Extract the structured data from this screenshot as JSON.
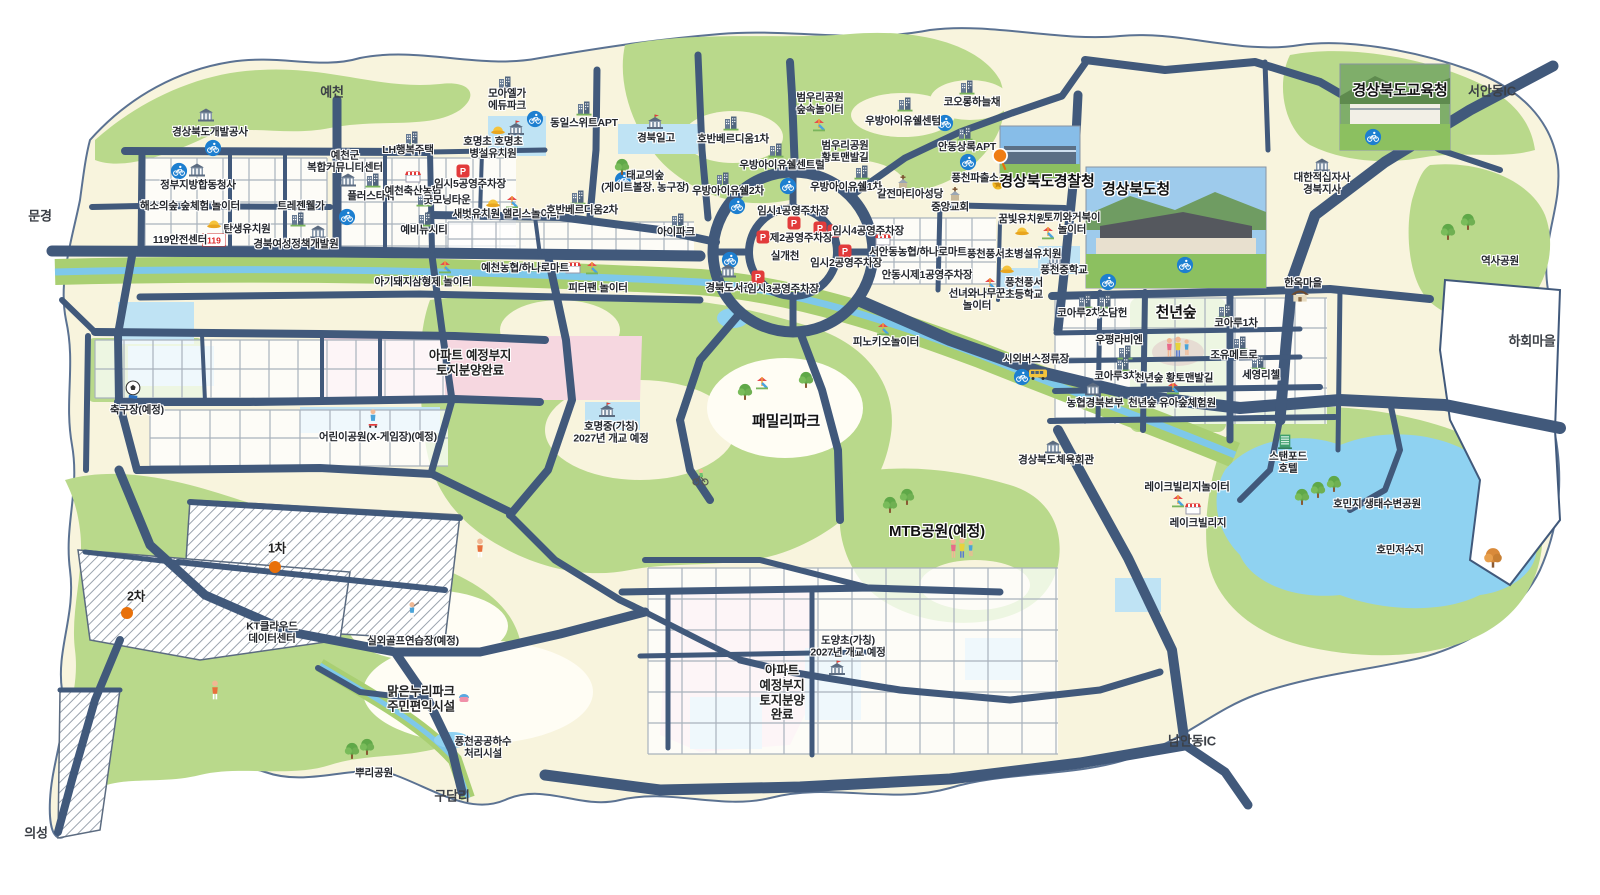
{
  "map": {
    "region_name_hint": "",
    "colors": {
      "road": "#41597b",
      "land": "#f8f4dd",
      "park": "#b9d98b",
      "water": "#8fd2f1",
      "stream_band": "#a9cf72",
      "zone_pink": "#f6d7e0",
      "zone_blue": "#bfe3f4",
      "marker_bike_blue": "#1d7fd0",
      "marker_parking_red": "#e23b3b",
      "dot_orange": "#e8700a"
    },
    "labels": [
      {
        "t": "예천",
        "x": 332,
        "y": 92,
        "s": "e"
      },
      {
        "t": "문경",
        "x": 40,
        "y": 216,
        "s": "e"
      },
      {
        "t": "의성",
        "x": 36,
        "y": 833,
        "s": "e"
      },
      {
        "t": "구담리",
        "x": 452,
        "y": 796,
        "s": "e"
      },
      {
        "t": "남안동IC",
        "x": 1192,
        "y": 741,
        "s": "e"
      },
      {
        "t": "서안동IC",
        "x": 1492,
        "y": 91,
        "s": "e"
      },
      {
        "t": "하회마을",
        "x": 1532,
        "y": 341,
        "s": "e"
      },
      {
        "t": "역사공원",
        "x": 1500,
        "y": 261,
        "s": "n"
      },
      {
        "t": "경상북도개발공사",
        "x": 210,
        "y": 132,
        "s": "n"
      },
      {
        "t": "정부지방합동청사",
        "x": 198,
        "y": 185,
        "s": "n"
      },
      {
        "t": "해소의숲 숲체험 놀이터",
        "x": 190,
        "y": 206,
        "s": "n"
      },
      {
        "t": "119안전센터",
        "x": 180,
        "y": 240,
        "s": "n"
      },
      {
        "t": "탄생유치원",
        "x": 247,
        "y": 229,
        "s": "n"
      },
      {
        "t": "트레젠웰가",
        "x": 301,
        "y": 206,
        "s": "n"
      },
      {
        "t": "경북여성정책개발원",
        "x": 296,
        "y": 244,
        "s": "n"
      },
      {
        "t": "예천군\n복합커뮤니티센터",
        "x": 345,
        "y": 162,
        "s": "n"
      },
      {
        "t": "LH행복주택",
        "x": 408,
        "y": 150,
        "s": "n"
      },
      {
        "t": "플러스타워",
        "x": 371,
        "y": 196,
        "s": "n"
      },
      {
        "t": "예천축산농협",
        "x": 413,
        "y": 191,
        "s": "n"
      },
      {
        "t": "굿모닝타운",
        "x": 447,
        "y": 200,
        "s": "n"
      },
      {
        "t": "예비뉴시티",
        "x": 424,
        "y": 230,
        "s": "n"
      },
      {
        "t": "임시5공영주차장",
        "x": 470,
        "y": 184,
        "s": "n"
      },
      {
        "t": "모아엘가\n에듀파크",
        "x": 507,
        "y": 100,
        "s": "n"
      },
      {
        "t": "호명초 호명초\n병설유치원",
        "x": 493,
        "y": 148,
        "s": "n"
      },
      {
        "t": "동일스위트APT",
        "x": 584,
        "y": 123,
        "s": "n"
      },
      {
        "t": "경북일고",
        "x": 656,
        "y": 138,
        "s": "n"
      },
      {
        "t": "태교의숲\n(게이트볼장, 농구장)",
        "x": 645,
        "y": 182,
        "s": "n"
      },
      {
        "t": "새벗유치원 앨리스놀이터",
        "x": 506,
        "y": 214,
        "s": "n"
      },
      {
        "t": "호반베르디움2차",
        "x": 582,
        "y": 210,
        "s": "n"
      },
      {
        "t": "아이파크",
        "x": 676,
        "y": 232,
        "s": "n"
      },
      {
        "t": "호반베르디움1차",
        "x": 733,
        "y": 139,
        "s": "n"
      },
      {
        "t": "범우리공원\n숲속놀이터",
        "x": 820,
        "y": 104,
        "s": "n"
      },
      {
        "t": "범우리공원\n황토맨발길",
        "x": 845,
        "y": 152,
        "s": "n"
      },
      {
        "t": "우방아이유쉘센텀",
        "x": 903,
        "y": 121,
        "s": "n"
      },
      {
        "t": "코오롱하늘채",
        "x": 972,
        "y": 102,
        "s": "n"
      },
      {
        "t": "우방아이유쉘센트럴",
        "x": 782,
        "y": 165,
        "s": "n"
      },
      {
        "t": "우방아이유쉘2차",
        "x": 728,
        "y": 191,
        "s": "n"
      },
      {
        "t": "우방아이유쉘1차",
        "x": 846,
        "y": 187,
        "s": "n"
      },
      {
        "t": "갈전마티아성당",
        "x": 910,
        "y": 194,
        "s": "n"
      },
      {
        "t": "안동상록APT",
        "x": 967,
        "y": 147,
        "s": "n"
      },
      {
        "t": "풍천파출소",
        "x": 975,
        "y": 178,
        "s": "n"
      },
      {
        "t": "경상북도경찰청",
        "x": 1047,
        "y": 182,
        "s": "b"
      },
      {
        "t": "경상북도청",
        "x": 1136,
        "y": 190,
        "s": "b"
      },
      {
        "t": "중앙교회",
        "x": 950,
        "y": 207,
        "s": "n"
      },
      {
        "t": "꿈빛유치원",
        "x": 1022,
        "y": 219,
        "s": "n"
      },
      {
        "t": "토끼와거북이\n놀이터",
        "x": 1072,
        "y": 224,
        "s": "n"
      },
      {
        "t": "풍천풍서초병설유치원",
        "x": 1014,
        "y": 254,
        "s": "n"
      },
      {
        "t": "풍천중학교",
        "x": 1064,
        "y": 270,
        "s": "n"
      },
      {
        "t": "풍천풍서\n초등학교",
        "x": 1024,
        "y": 289,
        "s": "n"
      },
      {
        "t": "선녀와나무꾼\n놀이터",
        "x": 977,
        "y": 300,
        "s": "n"
      },
      {
        "t": "임시1공영주차장",
        "x": 793,
        "y": 211,
        "s": "n"
      },
      {
        "t": "제2공영주차장",
        "x": 801,
        "y": 238,
        "s": "n"
      },
      {
        "t": "임시4공영주차장",
        "x": 868,
        "y": 231,
        "s": "n"
      },
      {
        "t": "실개천",
        "x": 785,
        "y": 256,
        "s": "n"
      },
      {
        "t": "임시2공영주차장",
        "x": 846,
        "y": 263,
        "s": "n"
      },
      {
        "t": "서안동농협/하나로마트",
        "x": 918,
        "y": 252,
        "s": "n"
      },
      {
        "t": "안동시제1공영주차장",
        "x": 927,
        "y": 275,
        "s": "n"
      },
      {
        "t": "경북도서관",
        "x": 729,
        "y": 288,
        "s": "n"
      },
      {
        "t": "임시3공영주차장",
        "x": 783,
        "y": 289,
        "s": "n"
      },
      {
        "t": "예천농협/하나로마트",
        "x": 525,
        "y": 268,
        "s": "n"
      },
      {
        "t": "아기돼지삼형제 놀이터",
        "x": 423,
        "y": 282,
        "s": "n"
      },
      {
        "t": "피터팬 놀이터",
        "x": 598,
        "y": 288,
        "s": "n"
      },
      {
        "t": "피노키오놀이터",
        "x": 886,
        "y": 342,
        "s": "n"
      },
      {
        "t": "시외버스정류장",
        "x": 1036,
        "y": 359,
        "s": "n"
      },
      {
        "t": "코아루2차",
        "x": 1079,
        "y": 313,
        "s": "n"
      },
      {
        "t": "소담헌",
        "x": 1113,
        "y": 313,
        "s": "n"
      },
      {
        "t": "우평라비엔",
        "x": 1119,
        "y": 340,
        "s": "n"
      },
      {
        "t": "코아루3차",
        "x": 1116,
        "y": 376,
        "s": "n"
      },
      {
        "t": "농협경북본부",
        "x": 1095,
        "y": 403,
        "s": "n"
      },
      {
        "t": "천년숲",
        "x": 1176,
        "y": 313,
        "s": "b"
      },
      {
        "t": "천년숲 황토맨발길",
        "x": 1174,
        "y": 378,
        "s": "n"
      },
      {
        "t": "천년숲 유아숲체험원",
        "x": 1172,
        "y": 403,
        "s": "n"
      },
      {
        "t": "코아루1차",
        "x": 1236,
        "y": 323,
        "s": "n"
      },
      {
        "t": "조유메트로",
        "x": 1234,
        "y": 355,
        "s": "n"
      },
      {
        "t": "세영리첼",
        "x": 1261,
        "y": 375,
        "s": "n"
      },
      {
        "t": "한옥마을",
        "x": 1303,
        "y": 283,
        "s": "n"
      },
      {
        "t": "대한적십자사\n경북지사",
        "x": 1322,
        "y": 184,
        "s": "n"
      },
      {
        "t": "경상북도교육청",
        "x": 1400,
        "y": 91,
        "s": "b"
      },
      {
        "t": "스탠포드\n호텔",
        "x": 1288,
        "y": 463,
        "s": "n"
      },
      {
        "t": "경상북도체육회관",
        "x": 1056,
        "y": 460,
        "s": "n"
      },
      {
        "t": "레이크빌리지놀이터",
        "x": 1187,
        "y": 487,
        "s": "n"
      },
      {
        "t": "레이크빌리지",
        "x": 1198,
        "y": 523,
        "s": "n"
      },
      {
        "t": "호민지 생태수변공원",
        "x": 1377,
        "y": 504,
        "s": "n"
      },
      {
        "t": "호민저수지",
        "x": 1400,
        "y": 550,
        "s": "n"
      },
      {
        "t": "MTB공원(예정)",
        "x": 937,
        "y": 532,
        "s": "b"
      },
      {
        "t": "패밀리파크",
        "x": 786,
        "y": 422,
        "s": "b"
      },
      {
        "t": "호명중(가칭)\n2027년 개교 예정",
        "x": 611,
        "y": 433,
        "s": "n"
      },
      {
        "t": "아파트 예정부지\n토지분양완료",
        "x": 470,
        "y": 363,
        "s": "z"
      },
      {
        "t": "어린이공원(X-게임장)(예정)",
        "x": 378,
        "y": 437,
        "s": "n"
      },
      {
        "t": "축구장(예정)",
        "x": 137,
        "y": 410,
        "s": "n"
      },
      {
        "t": "1차",
        "x": 277,
        "y": 549,
        "s": "z"
      },
      {
        "t": "2차",
        "x": 136,
        "y": 597,
        "s": "z"
      },
      {
        "t": "KT클라우드\n데이터센터",
        "x": 272,
        "y": 633,
        "s": "n"
      },
      {
        "t": "실외골프연습장(예정)",
        "x": 413,
        "y": 641,
        "s": "n"
      },
      {
        "t": "맑은누리파크\n주민편익시설",
        "x": 421,
        "y": 699,
        "s": "z"
      },
      {
        "t": "풍천공공하수\n처리시설",
        "x": 483,
        "y": 748,
        "s": "n"
      },
      {
        "t": "뿌리공원",
        "x": 374,
        "y": 773,
        "s": "n"
      },
      {
        "t": "도양초(가칭)\n2027년 개교 예정",
        "x": 848,
        "y": 647,
        "s": "n"
      },
      {
        "t": "아파트\n예정부지\n토지분양\n완료",
        "x": 782,
        "y": 693,
        "s": "z"
      }
    ],
    "markers": [
      {
        "k": "bike",
        "x": 213,
        "y": 148
      },
      {
        "k": "bike",
        "x": 179,
        "y": 171
      },
      {
        "k": "bike",
        "x": 347,
        "y": 217
      },
      {
        "k": "bike",
        "x": 535,
        "y": 119
      },
      {
        "k": "bike",
        "x": 623,
        "y": 180
      },
      {
        "k": "bike",
        "x": 737,
        "y": 206
      },
      {
        "k": "bike",
        "x": 788,
        "y": 186
      },
      {
        "k": "bike",
        "x": 730,
        "y": 260
      },
      {
        "k": "bike",
        "x": 945,
        "y": 123
      },
      {
        "k": "bike",
        "x": 968,
        "y": 162
      },
      {
        "k": "bike",
        "x": 1108,
        "y": 282
      },
      {
        "k": "bike",
        "x": 1185,
        "y": 265
      },
      {
        "k": "bike",
        "x": 1022,
        "y": 377
      },
      {
        "k": "bike",
        "x": 1373,
        "y": 137
      },
      {
        "k": "parking",
        "x": 463,
        "y": 171
      },
      {
        "k": "parking",
        "x": 794,
        "y": 223
      },
      {
        "k": "parking",
        "x": 763,
        "y": 237
      },
      {
        "k": "parking",
        "x": 820,
        "y": 228
      },
      {
        "k": "parking",
        "x": 834,
        "y": 231
      },
      {
        "k": "parking",
        "x": 845,
        "y": 251
      },
      {
        "k": "parking",
        "x": 758,
        "y": 277
      },
      {
        "k": "p119",
        "x": 214,
        "y": 240
      },
      {
        "k": "kinder",
        "x": 214,
        "y": 224
      },
      {
        "k": "kinder",
        "x": 498,
        "y": 130
      },
      {
        "k": "kinder",
        "x": 493,
        "y": 203
      },
      {
        "k": "kinder",
        "x": 1022,
        "y": 231
      },
      {
        "k": "kinder",
        "x": 1007,
        "y": 269
      },
      {
        "k": "school",
        "x": 516,
        "y": 128
      },
      {
        "k": "school",
        "x": 655,
        "y": 122
      },
      {
        "k": "school",
        "x": 1055,
        "y": 258
      },
      {
        "k": "school",
        "x": 607,
        "y": 410
      },
      {
        "k": "school",
        "x": 837,
        "y": 668
      },
      {
        "k": "bldg",
        "x": 298,
        "y": 219
      },
      {
        "k": "bldg",
        "x": 412,
        "y": 138
      },
      {
        "k": "bldg",
        "x": 373,
        "y": 180
      },
      {
        "k": "bldg",
        "x": 424,
        "y": 199
      },
      {
        "k": "bldg",
        "x": 425,
        "y": 219
      },
      {
        "k": "bldg",
        "x": 505,
        "y": 83
      },
      {
        "k": "bldg",
        "x": 584,
        "y": 108
      },
      {
        "k": "bldg",
        "x": 578,
        "y": 197
      },
      {
        "k": "bldg",
        "x": 678,
        "y": 220
      },
      {
        "k": "bldg",
        "x": 731,
        "y": 123
      },
      {
        "k": "bldg",
        "x": 905,
        "y": 104
      },
      {
        "k": "bldg",
        "x": 967,
        "y": 87
      },
      {
        "k": "bldg",
        "x": 776,
        "y": 150
      },
      {
        "k": "bldg",
        "x": 723,
        "y": 179
      },
      {
        "k": "bldg",
        "x": 862,
        "y": 172
      },
      {
        "k": "bldg",
        "x": 965,
        "y": 133
      },
      {
        "k": "bldg",
        "x": 1085,
        "y": 301
      },
      {
        "k": "bldg",
        "x": 1105,
        "y": 301
      },
      {
        "k": "bldg",
        "x": 1125,
        "y": 352
      },
      {
        "k": "bldg",
        "x": 1123,
        "y": 364
      },
      {
        "k": "bldg",
        "x": 1225,
        "y": 311
      },
      {
        "k": "bldg",
        "x": 1240,
        "y": 343
      },
      {
        "k": "bldg",
        "x": 1258,
        "y": 362
      },
      {
        "k": "govt",
        "x": 206,
        "y": 115
      },
      {
        "k": "govt",
        "x": 197,
        "y": 170
      },
      {
        "k": "govt",
        "x": 318,
        "y": 232
      },
      {
        "k": "govt",
        "x": 348,
        "y": 180
      },
      {
        "k": "govt",
        "x": 728,
        "y": 271
      },
      {
        "k": "govt",
        "x": 1093,
        "y": 389
      },
      {
        "k": "govt",
        "x": 1322,
        "y": 165
      },
      {
        "k": "govt",
        "x": 1053,
        "y": 447
      },
      {
        "k": "church",
        "x": 903,
        "y": 182
      },
      {
        "k": "church",
        "x": 955,
        "y": 194
      },
      {
        "k": "store",
        "x": 413,
        "y": 177
      },
      {
        "k": "store",
        "x": 883,
        "y": 240
      },
      {
        "k": "store",
        "x": 573,
        "y": 268
      },
      {
        "k": "store",
        "x": 1193,
        "y": 509
      },
      {
        "k": "play",
        "x": 819,
        "y": 125
      },
      {
        "k": "play",
        "x": 512,
        "y": 202
      },
      {
        "k": "play",
        "x": 1048,
        "y": 233
      },
      {
        "k": "play",
        "x": 990,
        "y": 284
      },
      {
        "k": "play",
        "x": 445,
        "y": 267
      },
      {
        "k": "play",
        "x": 592,
        "y": 268
      },
      {
        "k": "play",
        "x": 883,
        "y": 329
      },
      {
        "k": "play",
        "x": 1173,
        "y": 388
      },
      {
        "k": "play",
        "x": 1178,
        "y": 501
      },
      {
        "k": "play",
        "x": 762,
        "y": 383
      },
      {
        "k": "bus",
        "x": 1038,
        "y": 375
      },
      {
        "k": "police",
        "x": 998,
        "y": 184
      },
      {
        "k": "pin",
        "x": 1000,
        "y": 160
      },
      {
        "k": "dot",
        "x": 275,
        "y": 567
      },
      {
        "k": "dot",
        "x": 127,
        "y": 613
      },
      {
        "k": "soccer",
        "x": 133,
        "y": 390
      },
      {
        "k": "tree",
        "x": 622,
        "y": 167
      },
      {
        "k": "tree",
        "x": 890,
        "y": 505
      },
      {
        "k": "tree",
        "x": 907,
        "y": 497
      },
      {
        "k": "tree",
        "x": 1318,
        "y": 490
      },
      {
        "k": "tree",
        "x": 1334,
        "y": 484
      },
      {
        "k": "tree",
        "x": 1302,
        "y": 497
      },
      {
        "k": "tree",
        "x": 352,
        "y": 751
      },
      {
        "k": "tree",
        "x": 367,
        "y": 747
      },
      {
        "k": "tree",
        "x": 1468,
        "y": 222
      },
      {
        "k": "tree",
        "x": 1448,
        "y": 232
      },
      {
        "k": "tree",
        "x": 806,
        "y": 380
      },
      {
        "k": "tree",
        "x": 745,
        "y": 392
      },
      {
        "k": "treeA",
        "x": 1493,
        "y": 558
      },
      {
        "k": "hanok",
        "x": 1300,
        "y": 296
      },
      {
        "k": "hotel",
        "x": 1285,
        "y": 441
      },
      {
        "k": "golfer",
        "x": 412,
        "y": 611
      },
      {
        "k": "person",
        "x": 480,
        "y": 548
      },
      {
        "k": "person",
        "x": 215,
        "y": 690
      },
      {
        "k": "family",
        "x": 962,
        "y": 548
      },
      {
        "k": "family",
        "x": 1178,
        "y": 347
      },
      {
        "k": "cyclist",
        "x": 700,
        "y": 477
      },
      {
        "k": "skater",
        "x": 373,
        "y": 419
      },
      {
        "k": "picnic",
        "x": 464,
        "y": 698
      }
    ]
  }
}
